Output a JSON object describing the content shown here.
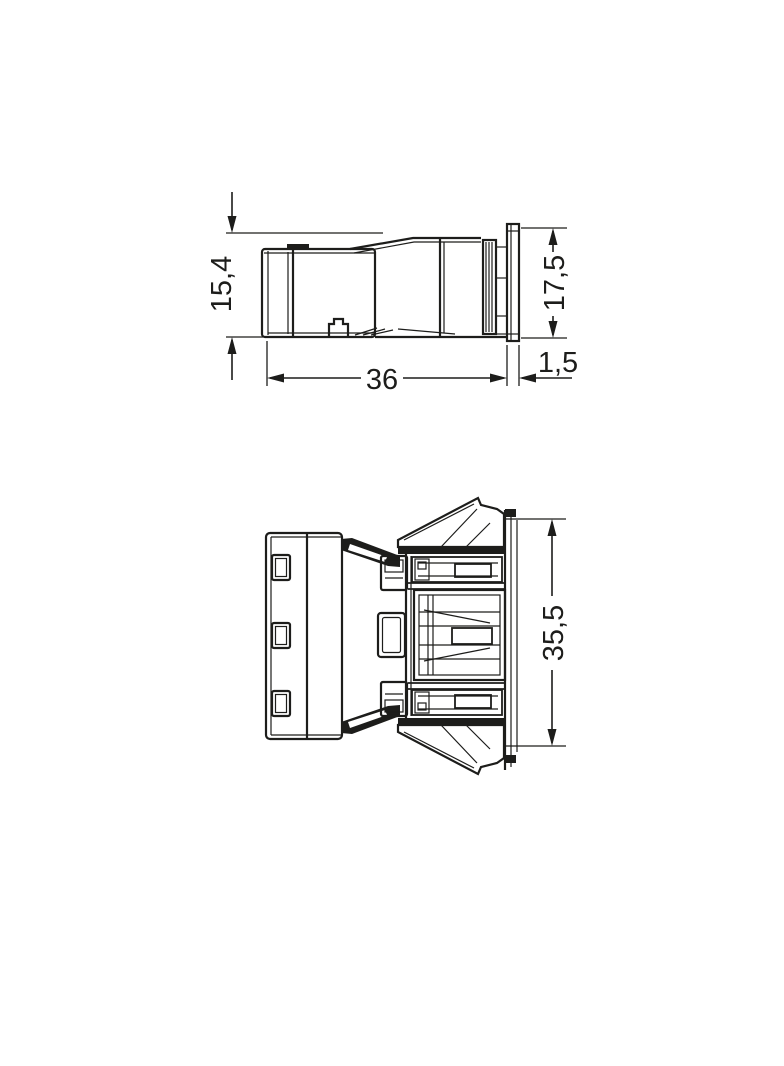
{
  "drawing": {
    "type": "technical-dimension-drawing",
    "background": "#ffffff",
    "line_color": "#1d1d1b",
    "views": {
      "side_view": {
        "name": "side view",
        "dimensions": {
          "front_height": "15,4",
          "overall_height": "17,5",
          "housing_length": "36",
          "flange_thickness": "1,5"
        }
      },
      "top_view": {
        "name": "top view",
        "dimensions": {
          "overall_width": "35,5"
        }
      }
    }
  }
}
